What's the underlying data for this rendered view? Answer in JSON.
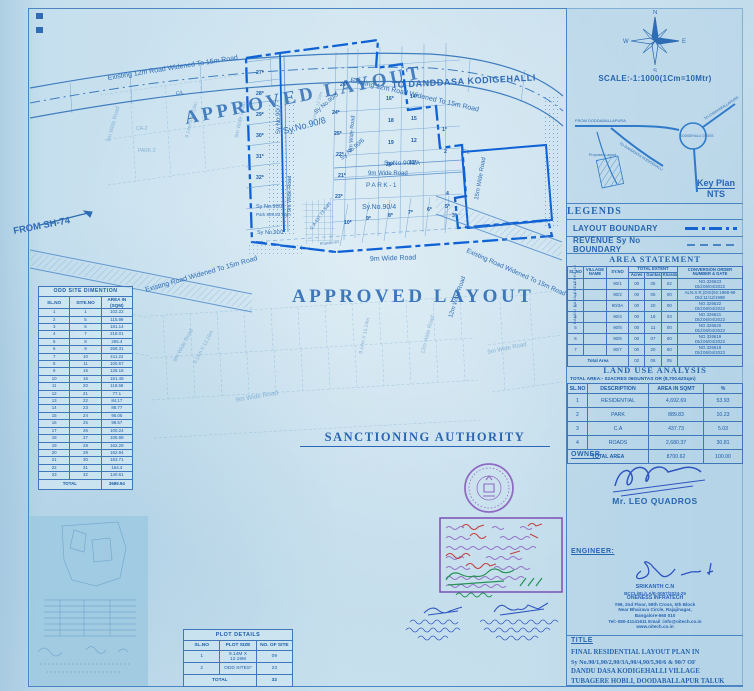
{
  "plan": {
    "labels": [
      "Existing 12m Road Widened To 15m Road",
      "C/L",
      "FROM SH-74",
      "APPROVED LAYOUT",
      "Existing 12m Road Widened To 15m Road",
      "TO DANDDASA KODIGEHALLI",
      "C/L",
      "Sy.No.90/8",
      "Sy No.90/7",
      "Sy No.90/5",
      "Sy No.90/6",
      "Sy.No.90/3A",
      "9m Wide Road",
      "PARK-1",
      "Sy.No.90/4",
      "Sy No.90/2",
      "Park 889.83 Sqm",
      "Sy No.90/1",
      "C.A 437.73 Sqm",
      "9m Wide Road",
      "APPROVED LAYOUT",
      "Existing Road Widened To 15m Road",
      "Kharab-3G",
      "Existing Road Widened To 15m Road",
      "15m Wide Road",
      "12m Wide Road",
      "9m Wide Road",
      "9m Wide Road",
      "9m Wide Road",
      "9.14m X 12.19m",
      "9m Wide Road",
      "9.14m X 15.24m",
      "12m Wide Road",
      "9m Wide Road",
      "9.14m X 12.19m",
      "9m Wide Road",
      "CA-2",
      "PARK-2",
      "9m Wide Road",
      "Kharab-50",
      "9.14m X 12.19m"
    ],
    "plots": [
      "27*",
      "28*",
      "29*",
      "30*",
      "31*",
      "32*",
      "26*",
      "16*",
      "14*",
      "18",
      "15",
      "19",
      "12",
      "20*",
      "11*",
      "24*",
      "25*",
      "22*",
      "21*",
      "23*",
      "1*",
      "2",
      "4",
      "3*",
      "10*",
      "9*",
      "8*",
      "7*",
      "6*",
      "5*"
    ]
  },
  "odd_sites": {
    "title": "ODD SITE DIMENTION",
    "headers": [
      "SL.NO",
      "SITE.NO",
      "AREA IN (SQM)"
    ],
    "rows": [
      [
        "1",
        "1",
        "102.22"
      ],
      [
        "2",
        "5",
        "115.99"
      ],
      [
        "3",
        "6",
        "181.14"
      ],
      [
        "4",
        "7",
        "218.01"
      ],
      [
        "5",
        "8",
        "265.4"
      ],
      [
        "6",
        "9",
        "268.31"
      ],
      [
        "7",
        "10",
        "411.22"
      ],
      [
        "8",
        "11",
        "100.57"
      ],
      [
        "9",
        "15",
        "128.18"
      ],
      [
        "10",
        "16",
        "151.48"
      ],
      [
        "11",
        "20",
        "118.58"
      ],
      [
        "12",
        "21",
        "77.1"
      ],
      [
        "13",
        "22",
        "84.17"
      ],
      [
        "14",
        "23",
        "88.77"
      ],
      [
        "15",
        "24",
        "95.05"
      ],
      [
        "16",
        "25",
        "98.57"
      ],
      [
        "17",
        "26",
        "100.24"
      ],
      [
        "18",
        "27",
        "105.98"
      ],
      [
        "19",
        "28",
        "162.29"
      ],
      [
        "20",
        "29",
        "162.94"
      ],
      [
        "21",
        "30",
        "163.71"
      ],
      [
        "22",
        "31",
        "164.4"
      ],
      [
        "23",
        "32",
        "140.61"
      ]
    ],
    "total_label": "TOTAL",
    "total": "3689.94"
  },
  "plot_details": {
    "title": "PLOT DETAILS",
    "headers": [
      "SL.NO",
      "PLOT SIZE",
      "NO. OF SITE"
    ],
    "rows": [
      [
        "1",
        "9.14M X 12.19M",
        "09"
      ],
      [
        "2",
        "ODD SITES*",
        "23"
      ]
    ],
    "total_label": "TOTAL",
    "total": "32"
  },
  "sanctioning": {
    "title": "SANCTIONING AUTHORITY"
  },
  "panel": {
    "compass": {
      "n": "N",
      "s": "S",
      "e": "E",
      "w": "W"
    },
    "scale": "SCALE:-1:1000(1Cm=10Mtr)",
    "keyplan": {
      "label": "Key Plan",
      "nts": "NTS",
      "labels": [
        "FROM DODDABALLAPURA",
        "KODIGEHALLI CROSS",
        "TO CHIKKABALLAPURA",
        "TO DANDDASA KODIGEHALLI",
        "Proposed Layout"
      ]
    },
    "legends": {
      "title": "LEGENDS",
      "items": [
        "LAYOUT BOUNDARY",
        "REVENUE Sy No BOUNDARY"
      ]
    },
    "area_statement": {
      "title": "AREA STATEMENT",
      "h": {
        "slno": "SL.NO",
        "village": "VILLAGE NAME",
        "syno": "SY.NO",
        "extent": "TOTAL EXTENT",
        "acres": "Acres",
        "guntas": "Guntas",
        "kharab": "Kharab",
        "conv": "CONVERSION ORDER NUMBER & DATE"
      },
      "village": "DANDU DASA KODIGEHALLI",
      "rows": [
        [
          "1",
          "",
          "90/1",
          "00",
          "05",
          "02",
          "NO.326623\nDtd:06/04/2022"
        ],
        [
          "2",
          "",
          "90/2",
          "00",
          "05",
          "00",
          "ALN.S.R.(DIS)92:1998-99\nDtd:11/12/1998"
        ],
        [
          "3",
          "",
          "90/3A",
          "00",
          "20",
          "00",
          "NO.326622\nDtd:06/04/2022"
        ],
        [
          "4",
          "",
          "90/4",
          "00",
          "18",
          "03",
          "NO.326621\nDtd:06/04/2022"
        ],
        [
          "5",
          "",
          "90/5",
          "00",
          "11",
          "00",
          "NO.326620\nDtd:06/04/2022"
        ],
        [
          "6",
          "",
          "90/6",
          "00",
          "07",
          "00",
          "NO.326619\nDtd:06/04/2022"
        ],
        [
          "7",
          "",
          "90/7",
          "00",
          "20",
          "00",
          "NO.326618\nDtd:06/04/2022"
        ]
      ],
      "total_label": "Total Area",
      "total": [
        "02",
        "06",
        "05"
      ]
    },
    "land_use": {
      "title": "LAND USE ANALYSIS",
      "subtitle": "TOTAL AREA:- 02ACRES 06GUNTAS OR (8,700.62Sqm)",
      "headers": [
        "SL.NO",
        "DESCRIPTION",
        "AREA IN SQMT",
        "%"
      ],
      "rows": [
        [
          "1",
          "RESIDENTIAL",
          "4,692.69",
          "53.93"
        ],
        [
          "2",
          "PARK",
          "889.83",
          "10.23"
        ],
        [
          "3",
          "C.A",
          "437.73",
          "5.03"
        ],
        [
          "4",
          "ROADS",
          "2,680.37",
          "30.81"
        ]
      ],
      "total_label": "TOTAL AREA",
      "total": [
        "8700.62",
        "100.00"
      ]
    },
    "owner": {
      "label": "OWNER",
      "name": "Mr. LEO QUADROS"
    },
    "engineer": {
      "label": "ENGINEER:",
      "lines": [
        "SRIKANTH C.N",
        "BCCL/BL/LA/E-0057/2024-25",
        "ONENESS INFRATECH",
        "#99, 2nd Floor, 59th Cross, 5th Block",
        "Near Bhairava Circle, Rajajinagar,",
        "Bangalore-560 010",
        "Tel:-080-41141611 Email :info@oitech.co.in",
        "www.oitech.co.in"
      ]
    },
    "title_block": {
      "label": "TITLE",
      "lines": [
        "FINAL RESIDENTIAL LAYOUT PLAN IN",
        "Sy No.90/1,90/2,90/3A,90/4,90/5,90/6 & 90/7  OF",
        "DANDU DASA KODIGEHALLI VILLAGE",
        "TUBAGERE HOBLI, DOODABALLAPUR TALUK"
      ]
    }
  }
}
